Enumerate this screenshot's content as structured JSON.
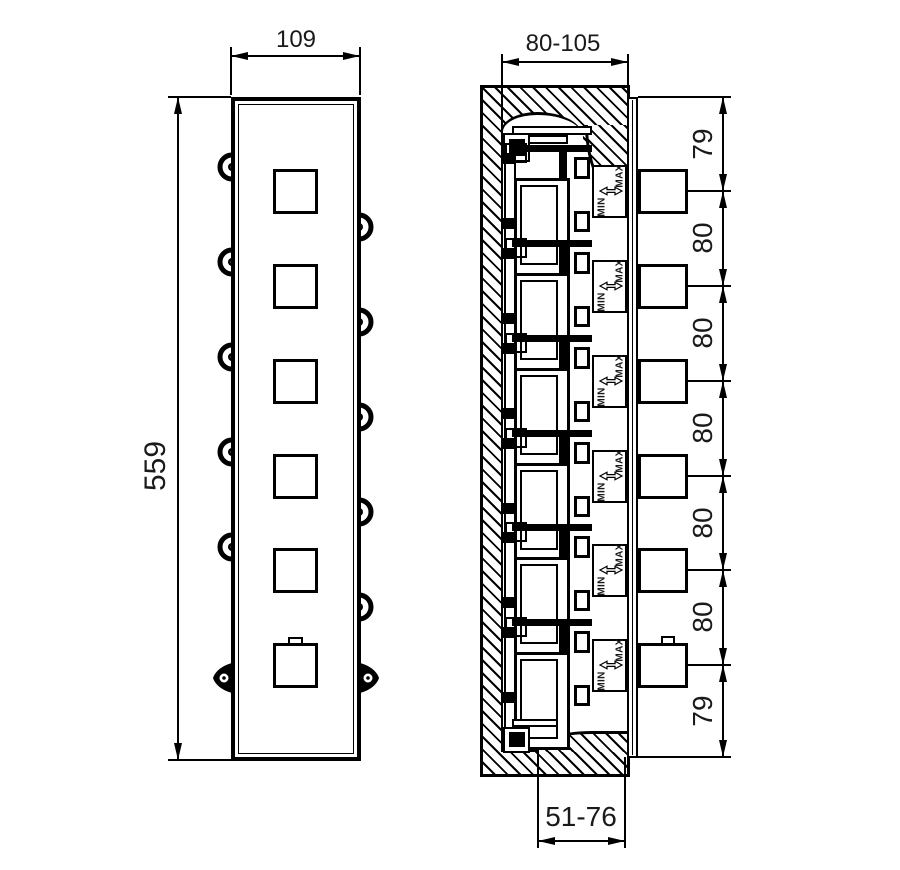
{
  "front_view": {
    "width_label": "109",
    "height_label": "559"
  },
  "section_view": {
    "depth_label": "80-105",
    "embed_depth_label": "51-76",
    "min_label": "MIN",
    "max_label": "MAX"
  },
  "outlet_spacing_labels": [
    "79",
    "80",
    "80",
    "80",
    "80",
    "80",
    "79"
  ]
}
